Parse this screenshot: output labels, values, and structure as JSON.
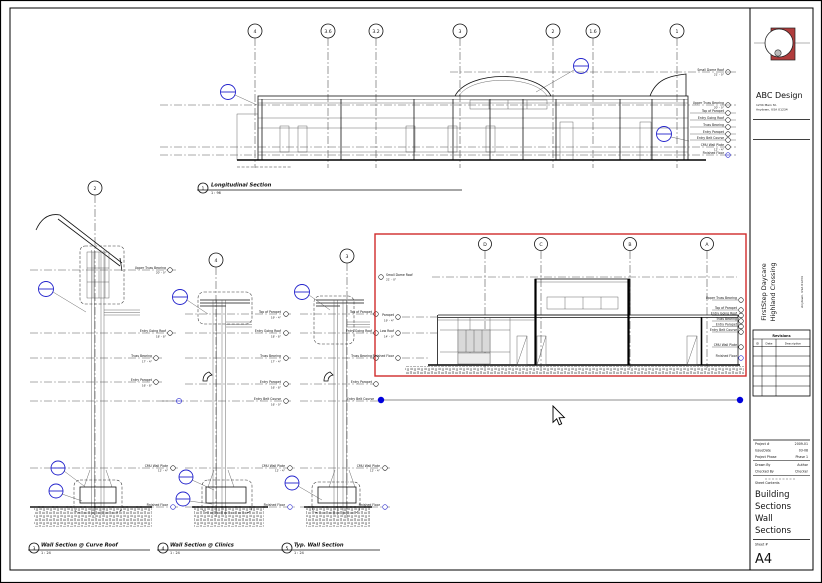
{
  "sheet": {
    "firm_name": "ABC Design",
    "firm_address1": "1234 Main St.",
    "firm_address2": "Anytown, USA 01234",
    "project_line1": "FirstStep Daycare",
    "project_line2": "Highland Crossing",
    "project_address": "Anytown, USA 01234",
    "revisions_title": "Revisions",
    "rev_col_id": "ID",
    "rev_col_date": "Date",
    "rev_col_desc": "Description",
    "fields": [
      {
        "label": "Project #",
        "value": "2009-01"
      },
      {
        "label": "IssueDate",
        "value": "03-08"
      },
      {
        "label": "Project Phase",
        "value": "Phase 1"
      },
      {
        "label": "Drawn By",
        "value": "Author"
      },
      {
        "label": "Checked By",
        "value": "Checker"
      }
    ],
    "contents_label": "Sheet Contents",
    "contents_lines": [
      "Building",
      "Sections",
      "Wall",
      "Sections"
    ],
    "sheet_no_label": "Sheet #",
    "sheet_no": "A4"
  },
  "grids": {
    "elevation": [
      "4",
      "3.6",
      "3.2",
      "3",
      "2",
      "1.6",
      "1"
    ],
    "cross": [
      "D",
      "C",
      "B",
      "A"
    ],
    "wallA": "2",
    "wallB": "4",
    "wallC": "3"
  },
  "levels": [
    {
      "name": "Small Dome Roof",
      "elev": "21' - 0\""
    },
    {
      "name": "Upper Truss Bearing",
      "elev": "20' - 0\""
    },
    {
      "name": "Top of Parapet",
      "elev": "19' - 4\""
    },
    {
      "name": "Entry Going Roof",
      "elev": "18' - 8\""
    },
    {
      "name": "Truss Bearing",
      "elev": "17' - 4\""
    },
    {
      "name": "Entry Parapet",
      "elev": "16' - 8\""
    },
    {
      "name": "Entry Belt Course",
      "elev": "16' - 0\""
    },
    {
      "name": "CMU Wall Plate",
      "elev": "12' - 4\""
    },
    {
      "name": "Finished Floor",
      "elev": "0\""
    },
    {
      "name": "Parapet",
      "elev": "19' - 4\""
    },
    {
      "name": "Low Roof",
      "elev": "14' - 0\""
    }
  ],
  "captions": [
    {
      "num": "1",
      "title": "Longitudinal Section",
      "scale": "1 : 96"
    },
    {
      "num": "3",
      "title": "Wall Section @ Curve Roof",
      "scale": "1 : 24"
    },
    {
      "num": "4",
      "title": "Wall Section @ Clinics",
      "scale": "1 : 24"
    },
    {
      "num": "5",
      "title": "Typ. Wall Section",
      "scale": "1 : 24"
    }
  ],
  "colors": {
    "selection": "#cf2b2b",
    "annotation": "#2323cc",
    "grip": "#0000dd",
    "logo": "#b03c3c"
  }
}
